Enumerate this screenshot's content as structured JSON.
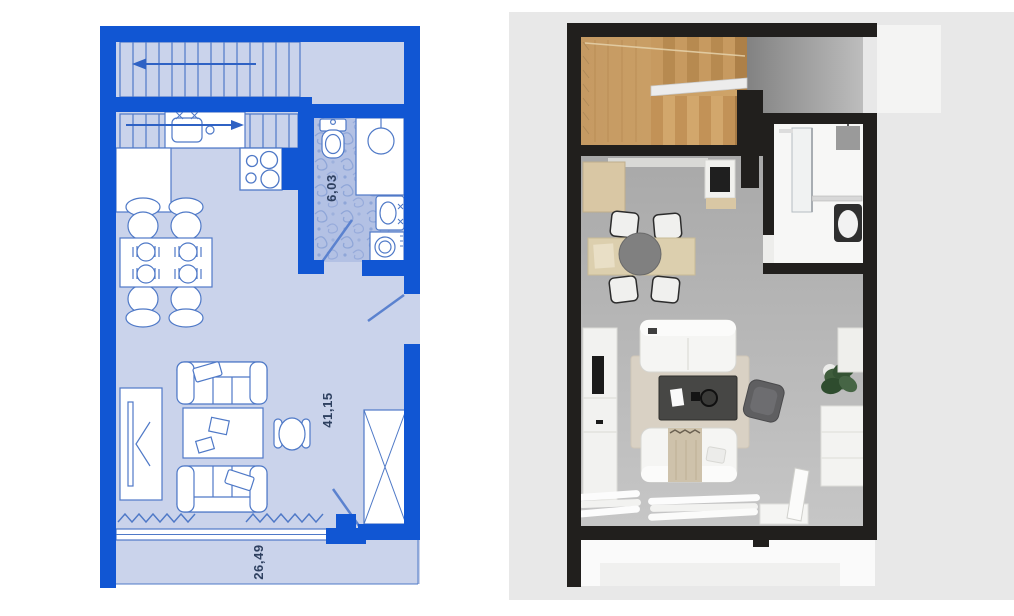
{
  "canvas": {
    "width": 1014,
    "height": 616,
    "background": "#ffffff"
  },
  "plan_2d": {
    "label": "2D architectural floor plan, top view",
    "dimensions": {
      "bathroom": "6,03",
      "living_room": "41,15",
      "terrace": "26,49"
    },
    "colors": {
      "wall": "#1156d3",
      "floor": "#cad3eb",
      "line": "#4f79c7",
      "furniture_fill": "#ffffff",
      "bath_floor_base": "#b3c1e4",
      "bath_pattern": "#8fa6d8",
      "dimension_text": "#2e4060"
    },
    "rooms": [
      "staircase",
      "kitchen",
      "bathroom",
      "living-dining-room",
      "balcony"
    ],
    "objects": [
      "stair-flight-up",
      "stair-flight-down",
      "kitchen-sink",
      "cooktop",
      "kitchen-cabinet",
      "dining-table",
      "dining-chairs",
      "toilet",
      "shower",
      "washbasin",
      "washing-machine",
      "tv-stand",
      "sofa",
      "coffee-table",
      "armchair",
      "wardrobe",
      "window",
      "balcony-door",
      "curtains"
    ]
  },
  "plan_3d": {
    "label": "3D rendered floor plan, top view",
    "colors": {
      "card": "#e8e8e8",
      "wall": "#211f1d",
      "floor": "#b5b5b5",
      "wood_light": "#d2a76c",
      "wood_dark": "#b78a50",
      "bathroom_floor": "#f6f6f5",
      "rug": "#d9d1c4",
      "sofa": "#f5f5f3",
      "dining_table": "#dccfae",
      "coffee_table": "#474745",
      "armchair": "#5f5f61",
      "plant": "#3f5d3c",
      "balcony": "#fafafa"
    },
    "rooms": [
      "staircase",
      "kitchen",
      "bathroom",
      "living-dining-room",
      "balcony"
    ],
    "objects": [
      "wooden-staircase",
      "kitchen-cabinet",
      "cooktop",
      "dining-table",
      "round-tray",
      "dining-chairs",
      "glass-shower",
      "toilet",
      "tv-console",
      "tv",
      "sofa",
      "coffee-table",
      "rug",
      "armchair",
      "potted-plant",
      "storage-cabinet",
      "curtains",
      "open-door"
    ]
  }
}
